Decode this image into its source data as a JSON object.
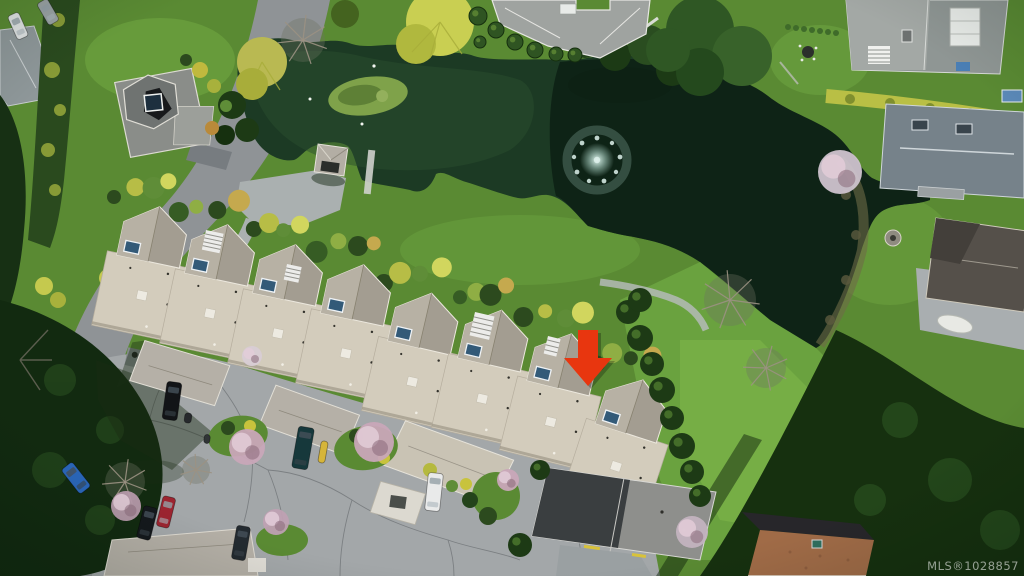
{
  "watermark": {
    "text": "MLS®1028857"
  },
  "marker": {
    "name": "property-location-arrow",
    "color": "#e8360f"
  },
  "palette": {
    "water": "#1c3a24",
    "water_shadow": "#0a1b11",
    "grass": "#5a8a33",
    "grass_light": "#74ab44",
    "road": "#8f9396",
    "pavement": "#a3a7a9",
    "roof_light": "#d3ccbc",
    "roof_peak": "#a39d91",
    "roof_gray": "#8f9694",
    "roof_slate": "#76828a",
    "roof_rust": "#a06b47",
    "hedge_yellow": "#b9bf45",
    "tree_dark": "#16300f",
    "skylight_blue": "#335a78",
    "blossom_pink": "#c9a6b8",
    "fountain_white": "#dff2ec"
  },
  "scene": {
    "townhouse_units": [
      {
        "x": 128,
        "y": 202,
        "rot": 12
      },
      {
        "x": 196,
        "y": 220,
        "rot": 12
      },
      {
        "x": 264,
        "y": 240,
        "rot": 12
      },
      {
        "x": 332,
        "y": 260,
        "rot": 12
      },
      {
        "x": 400,
        "y": 288,
        "rot": 13
      },
      {
        "x": 470,
        "y": 305,
        "rot": 13
      },
      {
        "x": 540,
        "y": 328,
        "rot": 14
      },
      {
        "x": 612,
        "y": 372,
        "rot": 18
      }
    ],
    "shrub_offsets": [
      [
        -14,
        -8
      ],
      [
        4,
        -16
      ],
      [
        22,
        -12
      ],
      [
        40,
        -18
      ]
    ],
    "shrub_colors": [
      "#2c4a1e",
      "#b7bd46",
      "#5f8d38",
      "#d1d65e",
      "#365c24",
      "#8fae44",
      "#2c4a1e",
      "#c5a94e"
    ],
    "cars": [
      {
        "x": 172,
        "y": 401,
        "w": 15,
        "l": 38,
        "rot": 8,
        "color": "#121417"
      },
      {
        "x": 303,
        "y": 448,
        "w": 16,
        "l": 42,
        "rot": 10,
        "color": "#16383b"
      },
      {
        "x": 323,
        "y": 452,
        "w": 7,
        "l": 22,
        "rot": 10,
        "color": "#d6b53a",
        "plain": true
      },
      {
        "x": 434,
        "y": 492,
        "w": 15,
        "l": 38,
        "rot": 6,
        "color": "#e9eaea"
      },
      {
        "x": 166,
        "y": 512,
        "w": 13,
        "l": 31,
        "rot": 14,
        "color": "#9c2430"
      },
      {
        "x": 147,
        "y": 523,
        "w": 14,
        "l": 33,
        "rot": 14,
        "color": "#14181c"
      },
      {
        "x": 241,
        "y": 543,
        "w": 14,
        "l": 34,
        "rot": 10,
        "color": "#232a30"
      },
      {
        "x": 76,
        "y": 478,
        "w": 14,
        "l": 31,
        "rot": -38,
        "color": "#2a66b8"
      },
      {
        "x": 18,
        "y": 26,
        "w": 12,
        "l": 26,
        "rot": -24,
        "color": "#dfe2e2"
      },
      {
        "x": 48,
        "y": 12,
        "w": 12,
        "l": 25,
        "rot": -30,
        "color": "#9aa2a4"
      },
      {
        "x": 188,
        "y": 418,
        "w": 7,
        "l": 10,
        "rot": 8,
        "color": "#26292c",
        "plain": true
      },
      {
        "x": 207,
        "y": 439,
        "w": 6,
        "l": 9,
        "rot": 8,
        "color": "#303436",
        "plain": true
      }
    ],
    "blossom_trees": [
      {
        "x": 247,
        "y": 447,
        "r": 18,
        "color": "#c9a6b8"
      },
      {
        "x": 126,
        "y": 506,
        "r": 15,
        "color": "#b79aab"
      },
      {
        "x": 374,
        "y": 442,
        "r": 20,
        "color": "#c9a6b8"
      },
      {
        "x": 276,
        "y": 522,
        "r": 13,
        "color": "#bfa0b2"
      },
      {
        "x": 252,
        "y": 356,
        "r": 10,
        "color": "#d8ccd4"
      },
      {
        "x": 840,
        "y": 172,
        "r": 22,
        "color": "#cfc3cd"
      },
      {
        "x": 692,
        "y": 532,
        "r": 16,
        "color": "#c3b3bf"
      },
      {
        "x": 508,
        "y": 480,
        "r": 11,
        "color": "#c9a6b8"
      }
    ],
    "bare_trees": [
      {
        "x": 125,
        "y": 482,
        "r": 20
      },
      {
        "x": 196,
        "y": 470,
        "r": 14
      },
      {
        "x": 730,
        "y": 300,
        "r": 26
      },
      {
        "x": 766,
        "y": 368,
        "r": 20
      },
      {
        "x": 303,
        "y": 40,
        "r": 22
      }
    ],
    "hedge_trees": [
      {
        "x": 628,
        "y": 312,
        "r": 12
      },
      {
        "x": 640,
        "y": 338,
        "r": 13
      },
      {
        "x": 652,
        "y": 364,
        "r": 12
      },
      {
        "x": 662,
        "y": 390,
        "r": 13
      },
      {
        "x": 672,
        "y": 418,
        "r": 12
      },
      {
        "x": 682,
        "y": 446,
        "r": 13
      },
      {
        "x": 692,
        "y": 472,
        "r": 12
      },
      {
        "x": 700,
        "y": 496,
        "r": 11
      },
      {
        "x": 640,
        "y": 300,
        "r": 12
      },
      {
        "x": 520,
        "y": 545,
        "r": 12
      },
      {
        "x": 540,
        "y": 470,
        "r": 10
      }
    ],
    "topiary_bushes": [
      {
        "x": 478,
        "y": 16,
        "r": 9
      },
      {
        "x": 496,
        "y": 30,
        "r": 8
      },
      {
        "x": 515,
        "y": 42,
        "r": 8
      },
      {
        "x": 535,
        "y": 50,
        "r": 8
      },
      {
        "x": 556,
        "y": 54,
        "r": 7
      },
      {
        "x": 575,
        "y": 55,
        "r": 7
      },
      {
        "x": 480,
        "y": 42,
        "r": 6
      }
    ]
  }
}
